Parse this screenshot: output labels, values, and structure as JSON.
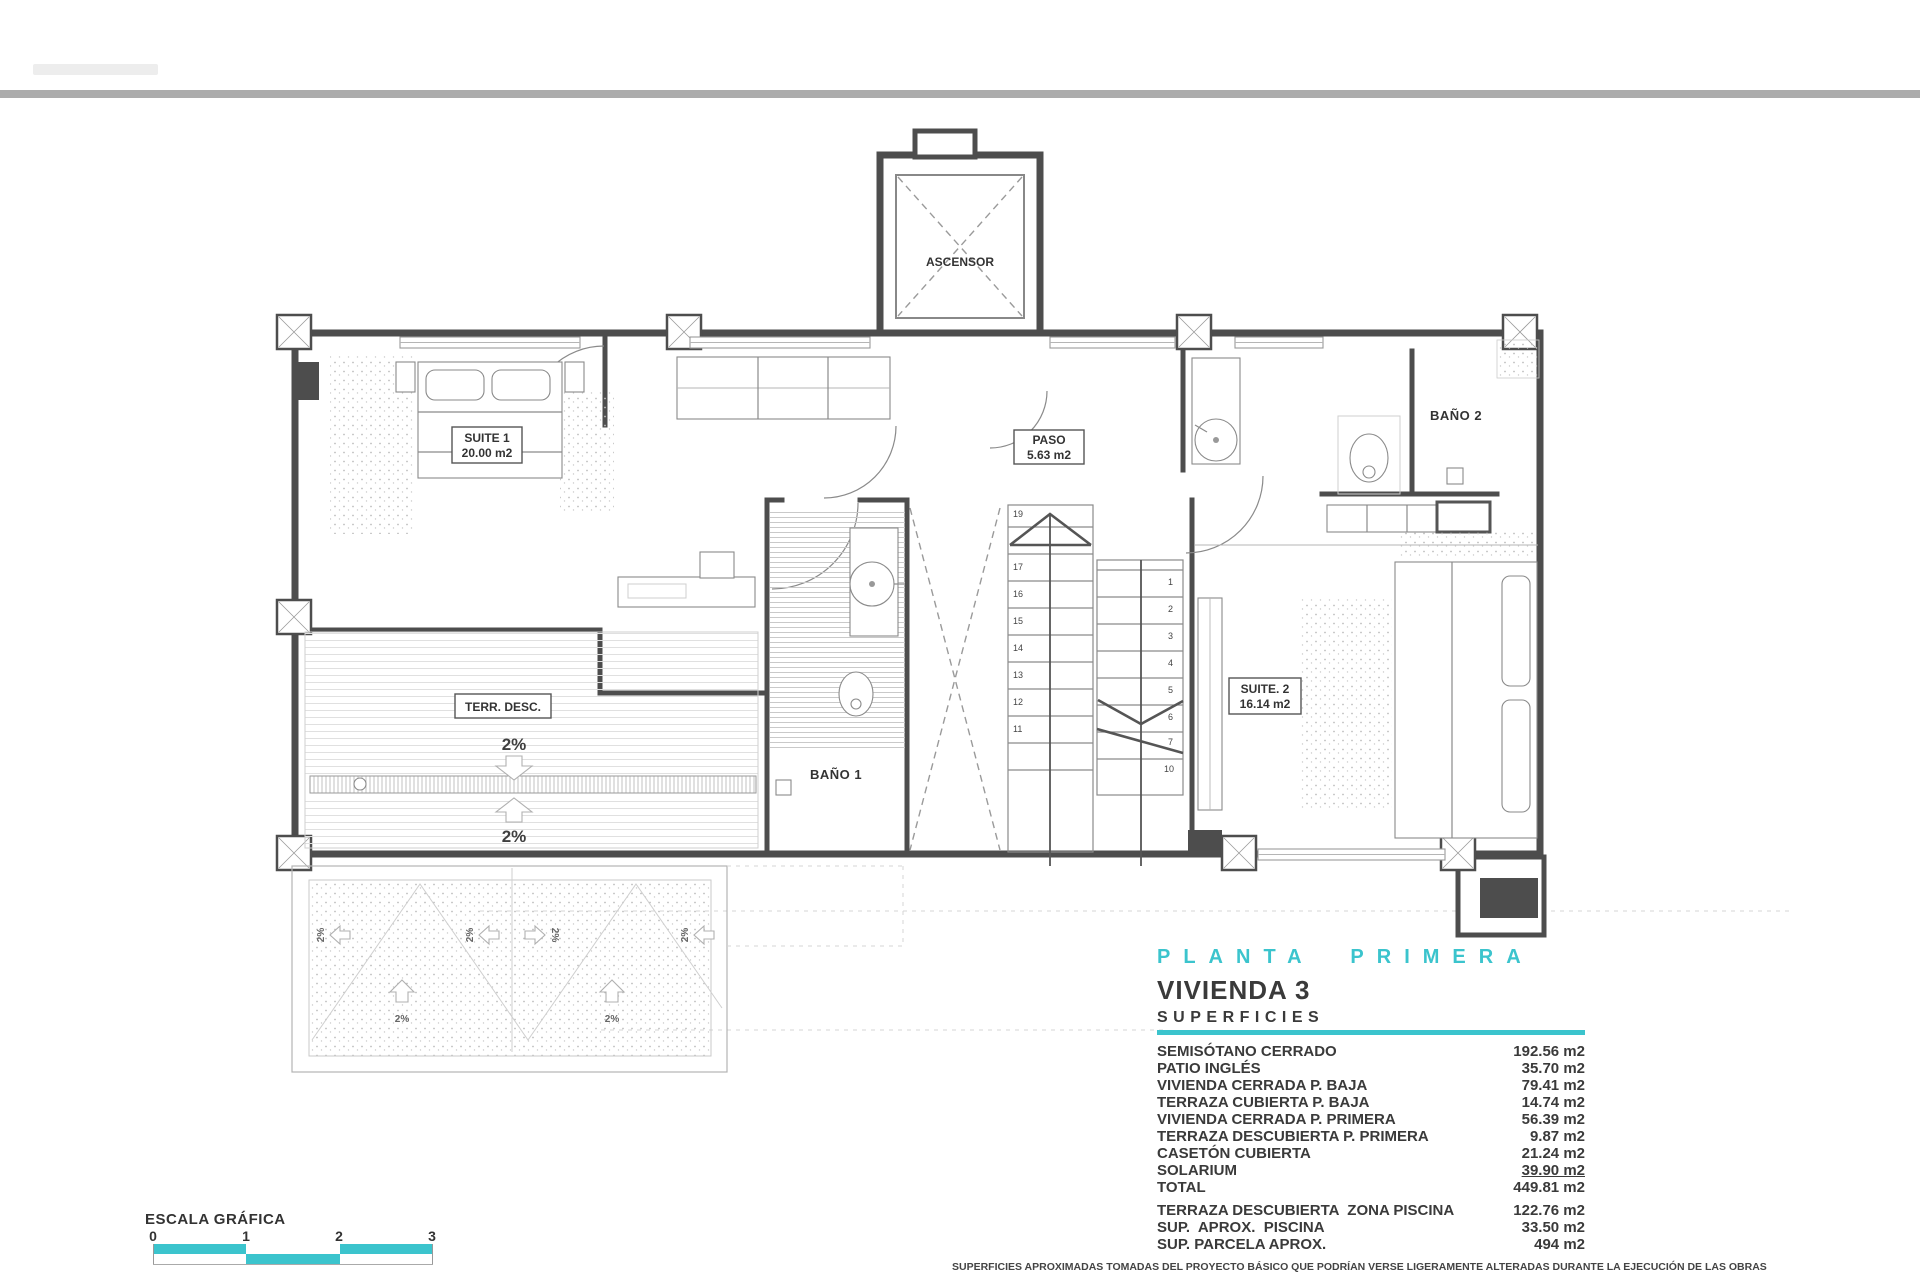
{
  "colors": {
    "accent": "#3bc4cd",
    "top_bar_gray": "#acacac",
    "wall": "#4d4d4d"
  },
  "plan": {
    "elevator_label": "ASCENSOR",
    "rooms": {
      "suite1": {
        "name": "SUITE 1",
        "area": "20.00 m2"
      },
      "paso": {
        "name": "PASO",
        "area": "5.63 m2"
      },
      "bano1": {
        "name": "BAÑO 1"
      },
      "bano2": {
        "name": "BAÑO 2"
      },
      "suite2": {
        "name": "SUITE. 2",
        "area": "16.14 m2"
      },
      "terraza": {
        "name": "TERR. DESC."
      }
    },
    "slope_label": "2%",
    "stairs": {
      "left": [
        "19",
        "17",
        "16",
        "15",
        "14",
        "13",
        "12",
        "11"
      ],
      "right": [
        "1",
        "2",
        "3",
        "4",
        "5",
        "6",
        "7",
        "10"
      ]
    }
  },
  "titleblock": {
    "plan_title": "PLANTA PRIMERA",
    "unit_title": "VIVIENDA 3",
    "section_title": "SUPERFICIES",
    "rows": [
      {
        "label": "SEMISÓTANO CERRADO",
        "value": "192.56 m2"
      },
      {
        "label": "PATIO INGLÉS",
        "value": "35.70 m2"
      },
      {
        "label": "VIVIENDA CERRADA P. BAJA",
        "value": "79.41 m2"
      },
      {
        "label": "TERRAZA CUBIERTA P. BAJA",
        "value": "14.74 m2"
      },
      {
        "label": "VIVIENDA CERRADA P. PRIMERA",
        "value": "56.39 m2"
      },
      {
        "label": "TERRAZA DESCUBIERTA P. PRIMERA",
        "value": "9.87 m2"
      },
      {
        "label": "CASETÓN CUBIERTA",
        "value": "21.24 m2"
      },
      {
        "label": "SOLARIUM",
        "value": "39.90 m2"
      },
      {
        "label": "TOTAL",
        "value": "449.81 m2"
      }
    ],
    "rows2": [
      {
        "label": "TERRAZA DESCUBIERTA  ZONA PISCINA",
        "value": "122.76 m2"
      },
      {
        "label": "SUP.  APROX.  PISCINA",
        "value": "33.50 m2"
      },
      {
        "label": "SUP. PARCELA APROX.",
        "value": "494 m2"
      }
    ],
    "disclaimer": "SUPERFICIES APROXIMADAS TOMADAS DEL PROYECTO BÁSICO QUE PODRÍAN VERSE LIGERAMENTE ALTERADAS DURANTE LA EJECUCIÓN DE LAS OBRAS"
  },
  "scale": {
    "title": "ESCALA GRÁFICA",
    "ticks": [
      "0",
      "1",
      "2",
      "3"
    ]
  }
}
